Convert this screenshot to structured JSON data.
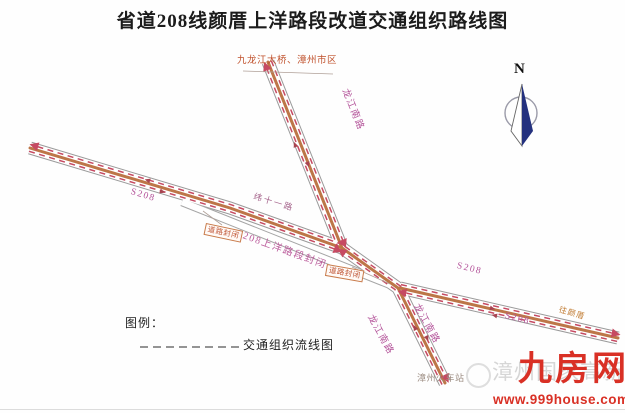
{
  "title": "省道208线颜厝上洋路段改道交通组织路线图",
  "compass": {
    "north_label": "N"
  },
  "destinations": {
    "top": "九龙江大桥、漳州市区",
    "right": "往颜厝",
    "station": "漳州火车站"
  },
  "road_labels": {
    "longjiang_north": "龙江南路",
    "longjiang_south_west": "龙江南路",
    "longjiang_south_east": "龙江南路",
    "s208_west": "S208",
    "s208_east_upper": "S208",
    "s208_east_lower": "S208",
    "wei_eleven": "纬十一路"
  },
  "closure": {
    "section_label": "S208上洋路段封闭",
    "sign_west": "道路封闭",
    "sign_east": "道路封闭"
  },
  "legend": {
    "heading": "图例：",
    "flow_line_label": "交通组织流线图"
  },
  "watermark": {
    "text": "漳州国家高新区"
  },
  "branding": {
    "site_name": "九房网",
    "site_url": "www.999house.com"
  },
  "colors": {
    "road_label_magenta": "#b4549a",
    "closure_text_orange": "#c05535",
    "flow_line_red": "#c64a62",
    "detour_highlight_orange": "#b96f3e",
    "brand_red": "#d93025",
    "compass_navy": "#24317e",
    "destination_orange": "#c0512c"
  }
}
